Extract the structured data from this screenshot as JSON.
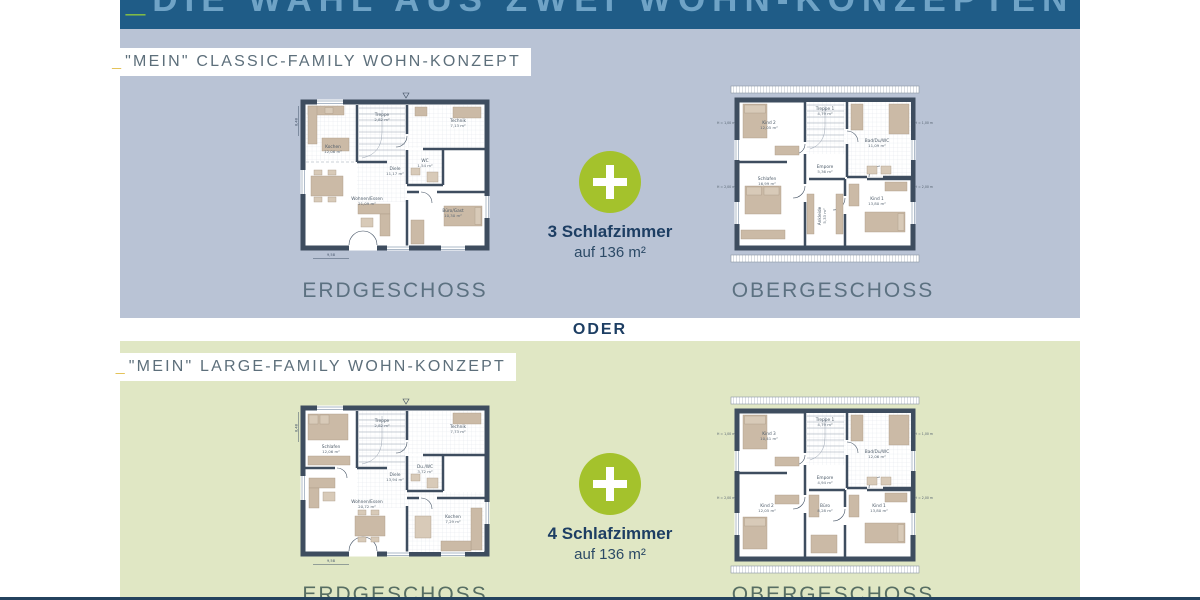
{
  "header": {
    "prefix": "_",
    "title": "DIE WAHL AUS ZWEI WOHN-KONZEPTEN"
  },
  "oder": "ODER",
  "sections": {
    "classic": {
      "label_prefix": "_",
      "label": "\"MEIN\" CLASSIC-FAMILY WOHN-KONZEPT",
      "plus": {
        "line1": "3 Schlafzimmer",
        "line2": "auf 136 m²"
      },
      "floors": {
        "left": "ERDGESCHOSS",
        "right": "OBERGESCHOSS"
      }
    },
    "large": {
      "label_prefix": "_",
      "label": "\"MEIN\" LARGE-FAMILY WOHN-KONZEPT",
      "plus": {
        "line1": "4 Schlafzimmer",
        "line2": "auf 136 m²"
      },
      "floors": {
        "left": "ERDGESCHOSS",
        "right": "OBERGESCHOSS"
      }
    }
  },
  "plans": {
    "classic_eg": {
      "rooms": {
        "r1": {
          "name": "Kochen",
          "area": "12,06 m²"
        },
        "r2": {
          "name": "Treppe",
          "area": "2,82 m²"
        },
        "r3": {
          "name": "Technik",
          "area": "7,13 m²"
        },
        "r4": {
          "name": "Diele",
          "area": "11,17 m²"
        },
        "r5": {
          "name": "WC",
          "area": "1,54 m²"
        },
        "r6": {
          "name": "Wohnen/Essen",
          "area": "21,09 m²"
        },
        "r7": {
          "name": "Büro/Gast",
          "area": "10,30 m²"
        }
      },
      "dims": {
        "width": "9,58",
        "height": "8,48"
      }
    },
    "classic_og": {
      "rooms": {
        "r1": {
          "name": "Kind 2",
          "area": "12,05 m²"
        },
        "r2": {
          "name": "Treppe 1",
          "area": "4,79 m²"
        },
        "r3": {
          "name": "Bad/Du/WC",
          "area": "11,09 m²"
        },
        "r4": {
          "name": "Empore",
          "area": "5,36 m²"
        },
        "r5": {
          "name": "Schlafen",
          "area": "16,99 m²"
        },
        "r6": {
          "name": "Ankleide",
          "area": "5,33 m²"
        },
        "r7": {
          "name": "Kind 1",
          "area": "13,80 m²"
        }
      },
      "dims": {
        "h1": "H = 1,00 m",
        "h2": "H = 2,00 m"
      }
    },
    "large_eg": {
      "rooms": {
        "r1": {
          "name": "Schlafen",
          "area": "12,06 m²"
        },
        "r2": {
          "name": "Treppe",
          "area": "2,82 m²"
        },
        "r3": {
          "name": "Technik",
          "area": "7,73 m²"
        },
        "r4": {
          "name": "Diele",
          "area": "13,94 m²"
        },
        "r5": {
          "name": "Du./WC",
          "area": "3,72 m²"
        },
        "r6": {
          "name": "Wohnen/Essen",
          "area": "20,72 m²"
        },
        "r7": {
          "name": "Kochen",
          "area": "7,29 m²"
        }
      },
      "dims": {
        "width": "9,58",
        "height": "8,48"
      }
    },
    "large_og": {
      "rooms": {
        "r1": {
          "name": "Kind 3",
          "area": "10,41 m²"
        },
        "r2": {
          "name": "Treppe 1",
          "area": "4,79 m²"
        },
        "r3": {
          "name": "Bad/Du/WC",
          "area": "12,06 m²"
        },
        "r4": {
          "name": "Empore",
          "area": "4,94 m²"
        },
        "r5": {
          "name": "Kind 2",
          "area": "12,05 m²"
        },
        "r6": {
          "name": "Büro",
          "area": "8,28 m²"
        },
        "r7": {
          "name": "Kind 1",
          "area": "13,80 m²"
        }
      },
      "dims": {
        "h1": "H = 1,00 m",
        "h2": "H = 2,00 m"
      }
    }
  },
  "colors": {
    "header_bg": "#1f5c87",
    "section_classic_bg": "#b9c3d5",
    "section_large_bg": "#e0e7c4",
    "plus_green": "#a4c22c",
    "navy_text": "#1d3e63",
    "accent_yellow": "#e4c35a",
    "accent_green": "#8dc63f"
  }
}
